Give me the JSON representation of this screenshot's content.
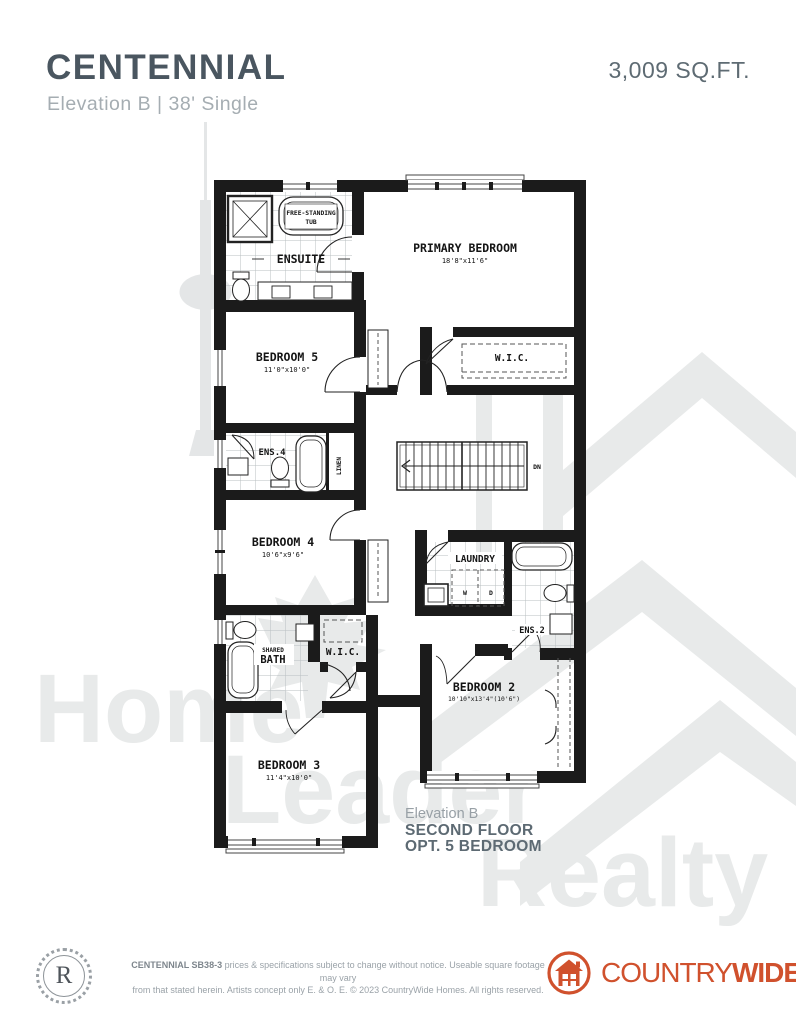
{
  "header": {
    "title": "CENTENNIAL",
    "subtitle": "Elevation B  |  38' Single",
    "sqft": "3,009 SQ.FT."
  },
  "plan": {
    "rooms": {
      "ensuite": {
        "label": "ENSUITE"
      },
      "tub": {
        "line1": "FREE-STANDING",
        "line2": "TUB"
      },
      "primary": {
        "label": "PRIMARY BEDROOM",
        "dims": "18'8\"x11'6\""
      },
      "wic1": {
        "label": "W.I.C."
      },
      "bed5": {
        "label": "BEDROOM 5",
        "dims": "11'0\"x10'0\""
      },
      "ens4": {
        "label": "ENS.4"
      },
      "linen": {
        "label": "LINEN"
      },
      "bed4": {
        "label": "BEDROOM 4",
        "dims": "10'6\"x9'6\""
      },
      "laundry": {
        "label": "LAUNDRY",
        "washer": "W",
        "dryer": "D"
      },
      "ens2": {
        "label": "ENS.2"
      },
      "sharedbath": {
        "line1": "SHARED",
        "line2": "BATH"
      },
      "wic2": {
        "label": "W.I.C."
      },
      "bed2": {
        "label": "BEDROOM 2",
        "dims": "10'10\"x13'4\"(10'6\")"
      },
      "bed3": {
        "label": "BEDROOM 3",
        "dims": "11'4\"x10'0\""
      }
    },
    "stairs": {
      "down_label": "DN"
    },
    "caption": {
      "line1": "Elevation B",
      "line2": "SECOND FLOOR",
      "line3": "OPT. 5 BEDROOM"
    }
  },
  "watermark": {
    "word1": "Home",
    "word2": "Leader",
    "word3": "Realty"
  },
  "footer": {
    "seal_letter": "R",
    "disclaimer_bold": "CENTENNIAL SB38-3",
    "disclaimer_rest": " prices & specifications subject to change without notice. Useable square footage may vary",
    "disclaimer_line2": "from that stated herein. Artists concept only E. & O. E. © 2023 CountryWide Homes. All rights reserved.",
    "brand_country": "COUNTRY",
    "brand_wide": "WIDE"
  },
  "colors": {
    "title": "#4A5660",
    "muted": "#A5ADB2",
    "accent_orange": "#D0512D",
    "plan_ink": "#161616",
    "watermark": "#E8EAEA"
  }
}
